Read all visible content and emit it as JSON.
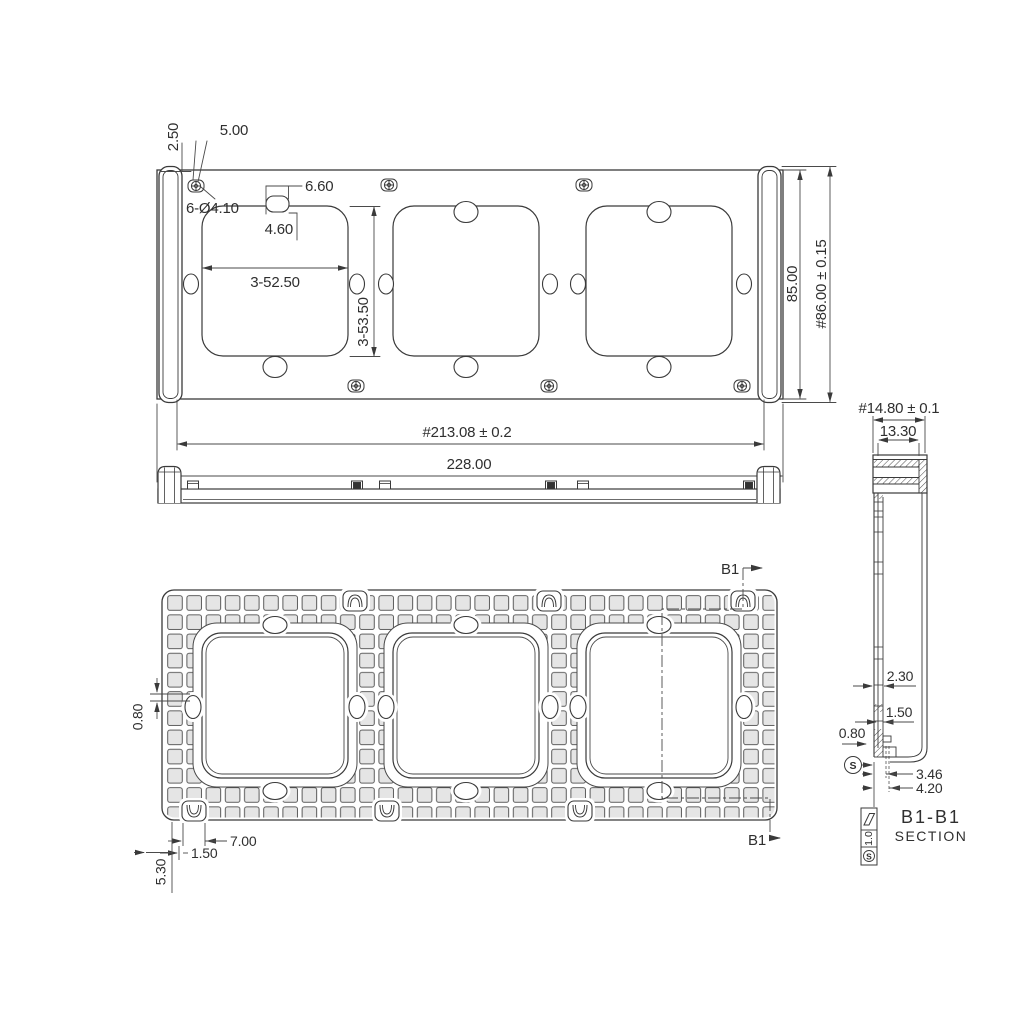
{
  "colors": {
    "line": "#3a3a3a",
    "dim_text": "#2f2f2f",
    "grid_cell_fill": "#e5e5e5",
    "background": "#ffffff"
  },
  "front_view": {
    "dims": {
      "offset_a": "2.50",
      "offset_b": "5.00",
      "holes": "6-Ø4.10",
      "slot_width": "6.60",
      "slot_height": "4.60",
      "opening_width": "3-52.50",
      "opening_height": "3-53.50",
      "plate_height": "85.00",
      "cap_height": "#86.00 ± 0.15",
      "mount_span": "#213.08 ± 0.2",
      "total_width": "228.00"
    }
  },
  "back_view": {
    "dims": {
      "rib": "0.80",
      "clip_width": "7.00",
      "clip_offset": "1.50",
      "edge_offset": "5.30"
    },
    "cut_label_top": "B1",
    "cut_label_bottom": "B1"
  },
  "section_view": {
    "dims": {
      "cap_width": "#14.80 ± 0.1",
      "cap_inner_width": "13.30",
      "wall_a": "2.30",
      "wall_b": "1.50",
      "rib": "0.80",
      "hook_a": "3.46",
      "hook_b": "4.20"
    },
    "title": "B1-B1",
    "subtitle": "SECTION",
    "finish": {
      "value": "1.0",
      "grade": "S"
    },
    "datum": "S"
  }
}
